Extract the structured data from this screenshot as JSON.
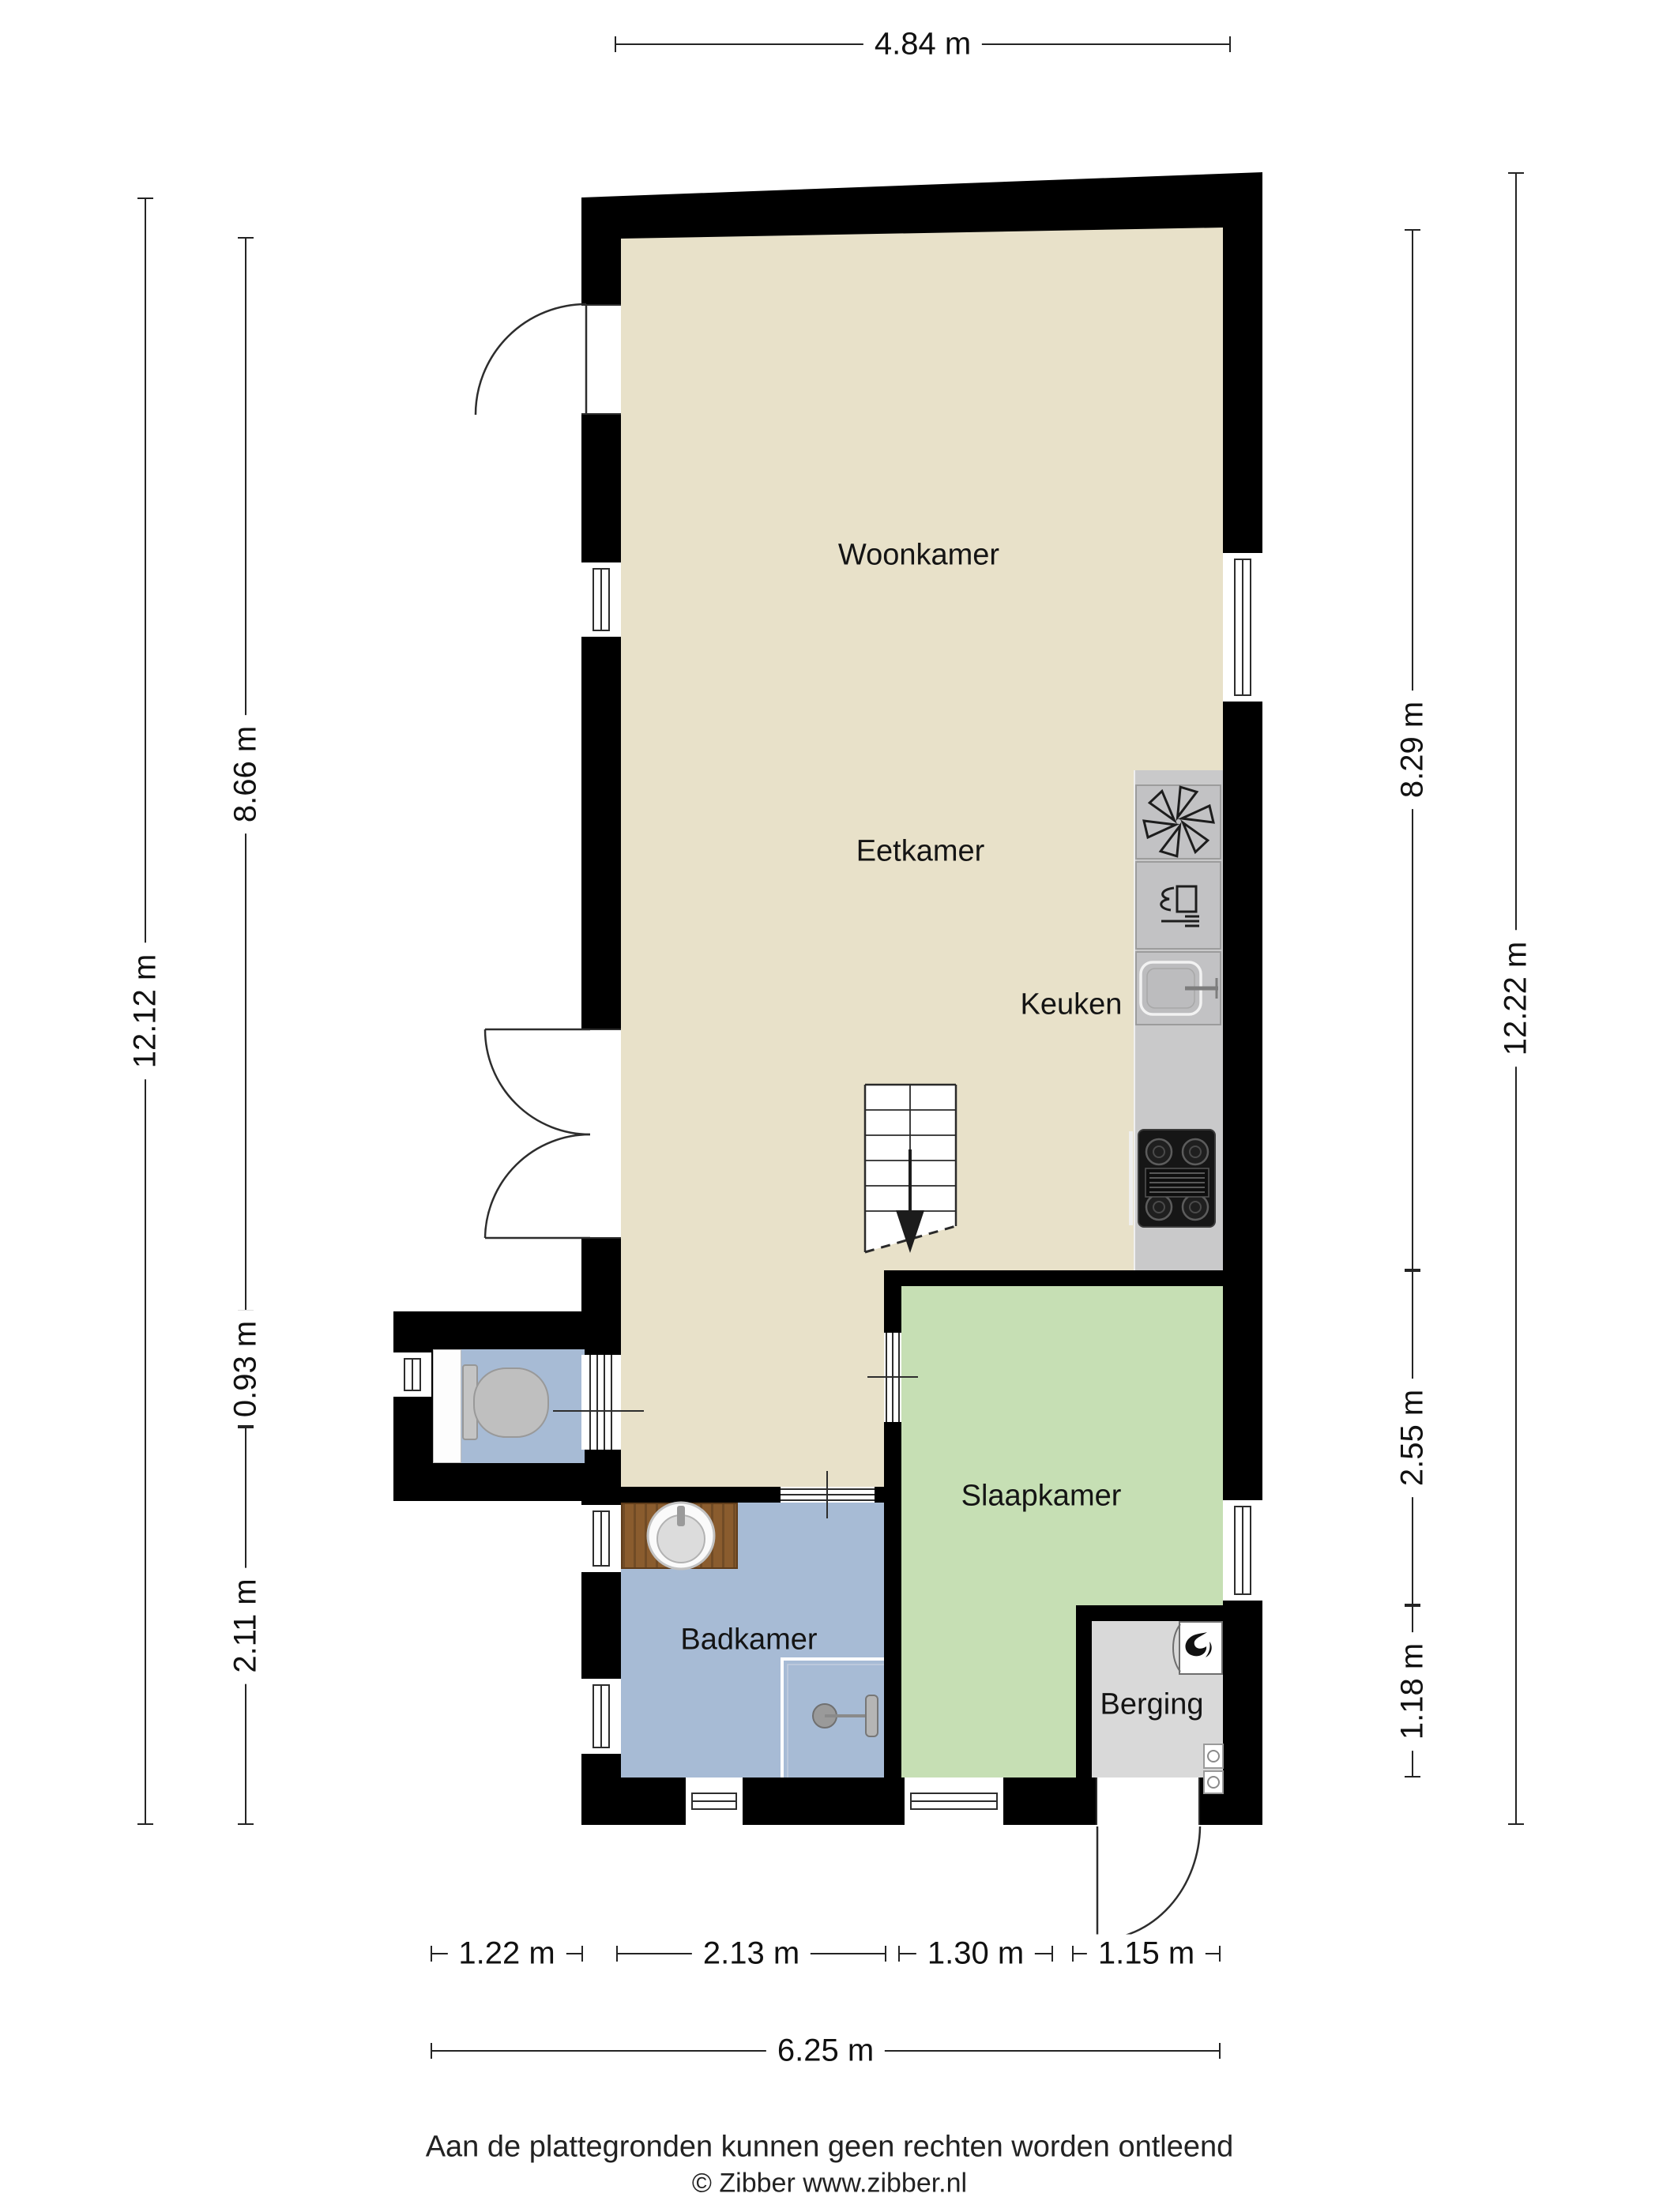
{
  "rooms": {
    "woonkamer": "Woonkamer",
    "eetkamer": "Eetkamer",
    "keuken": "Keuken",
    "slaapkamer": "Slaapkamer",
    "badkamer": "Badkamer",
    "berging": "Berging"
  },
  "dimensions": {
    "top": "4.84 m",
    "left_total": "12.12 m",
    "left_segments": [
      "8.66 m",
      "0.93 m",
      "2.11 m"
    ],
    "right_total": "12.22 m",
    "right_segments": [
      "8.29 m",
      "2.55 m",
      "1.18 m"
    ],
    "bottom_segments": [
      "1.22 m",
      "2.13 m",
      "1.30 m",
      "1.15 m"
    ],
    "bottom_total": "6.25 m"
  },
  "footer": {
    "disclaimer": "Aan de plattegronden kunnen geen rechten worden ontleend",
    "copyright": "© Zibber www.zibber.nl"
  },
  "colors": {
    "wall": "#000000",
    "floor-main": "#e8e1c9",
    "floor-bedroom": "#c6dfb4",
    "floor-bath": "#a7bbd5",
    "floor-storage": "#d9d9d9",
    "counter": "#c9c9ca",
    "wood": "#8a5c2e",
    "line": "#242424"
  },
  "icons": {
    "ventilation": "six-blade-fan-asterisk",
    "dishwasher": "glass-and-fork",
    "kitchen-sink": "basin-with-faucet",
    "stove": "four-burner-hob",
    "stairs": "stairs-down-arrow",
    "toilet": "toilet-top-view",
    "washbasin": "round-basin",
    "shower": "shower-head-and-drain",
    "boiler": "flame",
    "appliance-connections": "small-washer-symbols"
  }
}
